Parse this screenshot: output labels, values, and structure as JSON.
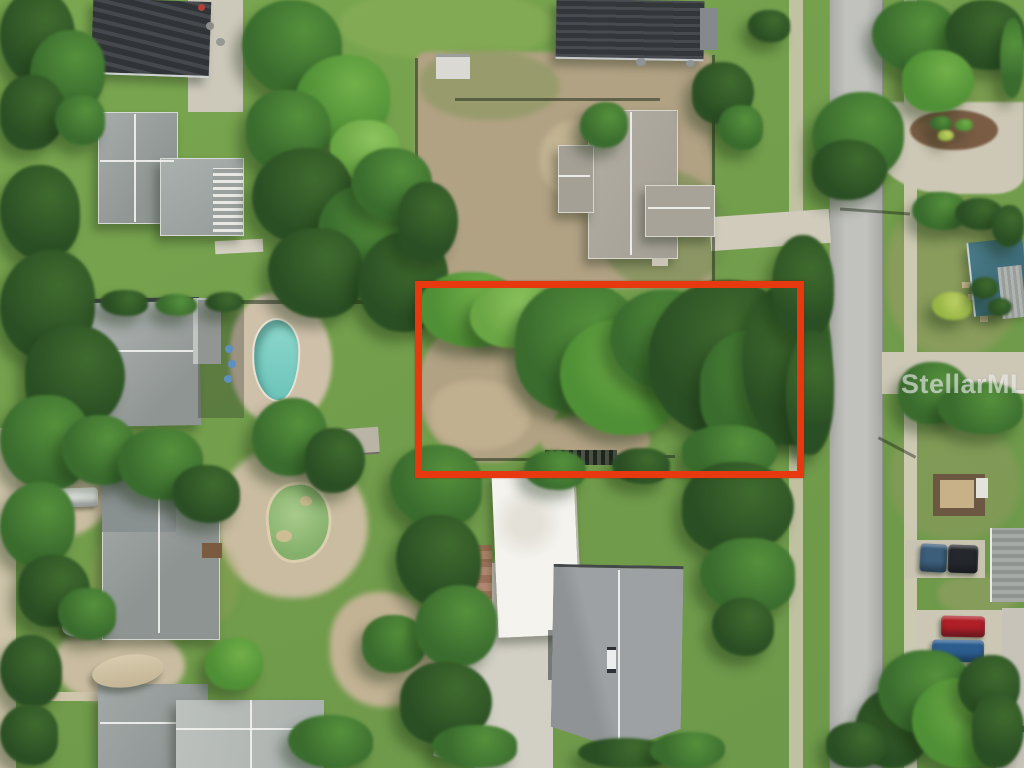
{
  "watermark": {
    "text": "StellarMLS",
    "color": "rgba(255,255,255,0.55)",
    "x": 901,
    "y": 369,
    "font_size": 27
  },
  "boundary": {
    "x": 415,
    "y": 281,
    "width": 375,
    "height": 183,
    "stroke_width": 7,
    "color": "#e7380f"
  },
  "palette": {
    "grass": "#74a04e",
    "dirt": "#b2a284",
    "sand": "#c9bca0",
    "road": "#b6b7b3",
    "concrete": "#cdc8b6",
    "pool_water": "#7fd0c5",
    "pond_water": "#94bb78",
    "dark_roof": "#3a3e42",
    "gray_roof": "#9ba19f",
    "tan_roof": "#aca79d",
    "white_roof": "#f4f3ee",
    "teal_roof": "#42707e",
    "trees": {
      "dark": {
        "fill": "#2b4f24",
        "hi": "#3f6b2e"
      },
      "mid": {
        "fill": "#3a6c2e",
        "hi": "#55913c"
      },
      "bright": {
        "fill": "#4f8f35",
        "hi": "#72b04a"
      },
      "light": {
        "fill": "#6aa644",
        "hi": "#8cc45e"
      },
      "yellow": {
        "fill": "#97b545",
        "hi": "#c2d468"
      }
    }
  },
  "scene": {
    "trees": [
      {
        "x": 0,
        "y": -10,
        "w": 75,
        "h": 95,
        "t": "dark"
      },
      {
        "x": 30,
        "y": 30,
        "w": 75,
        "h": 85,
        "t": "mid"
      },
      {
        "x": 0,
        "y": 75,
        "w": 65,
        "h": 75,
        "t": "dark"
      },
      {
        "x": 55,
        "y": 95,
        "w": 50,
        "h": 50,
        "t": "mid"
      },
      {
        "x": 242,
        "y": 0,
        "w": 100,
        "h": 95,
        "t": "mid"
      },
      {
        "x": 295,
        "y": 55,
        "w": 95,
        "h": 90,
        "t": "bright"
      },
      {
        "x": 246,
        "y": 90,
        "w": 85,
        "h": 80,
        "t": "mid"
      },
      {
        "x": 330,
        "y": 120,
        "w": 70,
        "h": 60,
        "t": "light"
      },
      {
        "x": 0,
        "y": 165,
        "w": 80,
        "h": 95,
        "t": "dark"
      },
      {
        "x": 0,
        "y": 250,
        "w": 95,
        "h": 110,
        "t": "dark"
      },
      {
        "x": 25,
        "y": 325,
        "w": 100,
        "h": 105,
        "t": "dark"
      },
      {
        "x": 0,
        "y": 395,
        "w": 90,
        "h": 95,
        "t": "mid"
      },
      {
        "x": 62,
        "y": 415,
        "w": 75,
        "h": 70,
        "t": "mid"
      },
      {
        "x": 252,
        "y": 148,
        "w": 100,
        "h": 95,
        "t": "dark"
      },
      {
        "x": 318,
        "y": 185,
        "w": 105,
        "h": 100,
        "t": "mid"
      },
      {
        "x": 268,
        "y": 228,
        "w": 95,
        "h": 90,
        "t": "dark"
      },
      {
        "x": 352,
        "y": 148,
        "w": 80,
        "h": 72,
        "t": "mid"
      },
      {
        "x": 358,
        "y": 232,
        "w": 90,
        "h": 100,
        "t": "dark"
      },
      {
        "x": 398,
        "y": 182,
        "w": 60,
        "h": 80,
        "t": "dark"
      },
      {
        "x": 100,
        "y": 290,
        "w": 48,
        "h": 26,
        "t": "dark"
      },
      {
        "x": 155,
        "y": 294,
        "w": 42,
        "h": 22,
        "t": "mid"
      },
      {
        "x": 205,
        "y": 292,
        "w": 38,
        "h": 20,
        "t": "dark"
      },
      {
        "x": 428,
        "y": 288,
        "w": 34,
        "h": 22,
        "t": "dark"
      },
      {
        "x": 468,
        "y": 292,
        "w": 30,
        "h": 18,
        "t": "dark"
      },
      {
        "x": 504,
        "y": 290,
        "w": 26,
        "h": 16,
        "t": "dark"
      },
      {
        "x": 580,
        "y": 102,
        "w": 48,
        "h": 46,
        "t": "mid"
      },
      {
        "x": 692,
        "y": 62,
        "w": 62,
        "h": 62,
        "t": "dark"
      },
      {
        "x": 718,
        "y": 105,
        "w": 45,
        "h": 45,
        "t": "mid"
      },
      {
        "x": 418,
        "y": 272,
        "w": 105,
        "h": 75,
        "t": "bright"
      },
      {
        "x": 470,
        "y": 283,
        "w": 85,
        "h": 65,
        "t": "light"
      },
      {
        "x": 515,
        "y": 282,
        "w": 130,
        "h": 130,
        "t": "mid"
      },
      {
        "x": 560,
        "y": 320,
        "w": 120,
        "h": 115,
        "t": "bright"
      },
      {
        "x": 610,
        "y": 290,
        "w": 110,
        "h": 100,
        "t": "mid"
      },
      {
        "x": 648,
        "y": 280,
        "w": 145,
        "h": 155,
        "t": "dark"
      },
      {
        "x": 700,
        "y": 330,
        "w": 115,
        "h": 120,
        "t": "mid"
      },
      {
        "x": 742,
        "y": 285,
        "w": 90,
        "h": 160,
        "t": "dark"
      },
      {
        "x": 772,
        "y": 235,
        "w": 62,
        "h": 105,
        "t": "dark"
      },
      {
        "x": 786,
        "y": 330,
        "w": 48,
        "h": 125,
        "t": "dark"
      },
      {
        "x": 682,
        "y": 425,
        "w": 95,
        "h": 55,
        "t": "mid"
      },
      {
        "x": 612,
        "y": 448,
        "w": 58,
        "h": 36,
        "t": "dark"
      },
      {
        "x": 524,
        "y": 450,
        "w": 62,
        "h": 40,
        "t": "mid"
      },
      {
        "x": 812,
        "y": 92,
        "w": 92,
        "h": 88,
        "t": "mid"
      },
      {
        "x": 812,
        "y": 140,
        "w": 75,
        "h": 60,
        "t": "dark"
      },
      {
        "x": 872,
        "y": 0,
        "w": 85,
        "h": 72,
        "t": "mid"
      },
      {
        "x": 945,
        "y": 0,
        "w": 80,
        "h": 70,
        "t": "dark"
      },
      {
        "x": 1000,
        "y": 18,
        "w": 24,
        "h": 80,
        "t": "mid"
      },
      {
        "x": 902,
        "y": 50,
        "w": 72,
        "h": 62,
        "t": "bright"
      },
      {
        "x": 912,
        "y": 192,
        "w": 55,
        "h": 38,
        "t": "mid"
      },
      {
        "x": 955,
        "y": 198,
        "w": 48,
        "h": 32,
        "t": "dark"
      },
      {
        "x": 992,
        "y": 205,
        "w": 32,
        "h": 42,
        "t": "dark"
      },
      {
        "x": 898,
        "y": 362,
        "w": 72,
        "h": 62,
        "t": "mid"
      },
      {
        "x": 938,
        "y": 382,
        "w": 85,
        "h": 52,
        "t": "mid"
      },
      {
        "x": 932,
        "y": 292,
        "w": 40,
        "h": 28,
        "t": "yellow"
      },
      {
        "x": 970,
        "y": 277,
        "w": 28,
        "h": 22,
        "t": "dark"
      },
      {
        "x": 988,
        "y": 298,
        "w": 24,
        "h": 18,
        "t": "dark"
      },
      {
        "x": 118,
        "y": 428,
        "w": 85,
        "h": 72,
        "t": "mid"
      },
      {
        "x": 172,
        "y": 465,
        "w": 68,
        "h": 58,
        "t": "dark"
      },
      {
        "x": 0,
        "y": 482,
        "w": 75,
        "h": 85,
        "t": "mid"
      },
      {
        "x": 18,
        "y": 555,
        "w": 72,
        "h": 72,
        "t": "dark"
      },
      {
        "x": 58,
        "y": 588,
        "w": 58,
        "h": 52,
        "t": "mid"
      },
      {
        "x": 0,
        "y": 635,
        "w": 62,
        "h": 72,
        "t": "dark"
      },
      {
        "x": 205,
        "y": 638,
        "w": 58,
        "h": 52,
        "t": "bright"
      },
      {
        "x": 362,
        "y": 615,
        "w": 65,
        "h": 58,
        "t": "mid"
      },
      {
        "x": 0,
        "y": 705,
        "w": 58,
        "h": 60,
        "t": "dark"
      },
      {
        "x": 288,
        "y": 715,
        "w": 85,
        "h": 53,
        "t": "mid"
      },
      {
        "x": 252,
        "y": 398,
        "w": 75,
        "h": 78,
        "t": "mid"
      },
      {
        "x": 305,
        "y": 428,
        "w": 60,
        "h": 65,
        "t": "dark"
      },
      {
        "x": 390,
        "y": 445,
        "w": 92,
        "h": 82,
        "t": "mid"
      },
      {
        "x": 396,
        "y": 515,
        "w": 85,
        "h": 92,
        "t": "dark"
      },
      {
        "x": 415,
        "y": 585,
        "w": 82,
        "h": 82,
        "t": "mid"
      },
      {
        "x": 400,
        "y": 662,
        "w": 92,
        "h": 82,
        "t": "dark"
      },
      {
        "x": 432,
        "y": 725,
        "w": 85,
        "h": 43,
        "t": "mid"
      },
      {
        "x": 578,
        "y": 738,
        "w": 92,
        "h": 30,
        "t": "dark"
      },
      {
        "x": 650,
        "y": 732,
        "w": 75,
        "h": 36,
        "t": "mid"
      },
      {
        "x": 682,
        "y": 462,
        "w": 112,
        "h": 92,
        "t": "dark"
      },
      {
        "x": 700,
        "y": 538,
        "w": 95,
        "h": 75,
        "t": "mid"
      },
      {
        "x": 712,
        "y": 598,
        "w": 62,
        "h": 58,
        "t": "dark"
      },
      {
        "x": 855,
        "y": 688,
        "w": 75,
        "h": 80,
        "t": "dark"
      },
      {
        "x": 826,
        "y": 722,
        "w": 62,
        "h": 46,
        "t": "dark"
      },
      {
        "x": 878,
        "y": 650,
        "w": 95,
        "h": 85,
        "t": "mid"
      },
      {
        "x": 912,
        "y": 678,
        "w": 95,
        "h": 90,
        "t": "bright"
      },
      {
        "x": 958,
        "y": 655,
        "w": 62,
        "h": 62,
        "t": "dark"
      },
      {
        "x": 972,
        "y": 692,
        "w": 52,
        "h": 76,
        "t": "dark"
      },
      {
        "x": 748,
        "y": 10,
        "w": 42,
        "h": 32,
        "t": "dark"
      },
      {
        "x": 930,
        "y": 116,
        "w": 22,
        "h": 15,
        "t": "mid"
      },
      {
        "x": 955,
        "y": 119,
        "w": 18,
        "h": 12,
        "t": "bright"
      },
      {
        "x": 938,
        "y": 130,
        "w": 16,
        "h": 11,
        "t": "yellow"
      }
    ],
    "vehicles": [
      {
        "name": "pickup-truck",
        "x": 52,
        "y": 287,
        "w": 42,
        "h": 16,
        "color": "#9fa6ab",
        "r": 2
      },
      {
        "name": "white-car",
        "x": 47,
        "y": 314,
        "w": 38,
        "h": 15,
        "color": "#e9eae6",
        "r": 2
      },
      {
        "name": "dark-car",
        "x": 56,
        "y": 337,
        "w": 24,
        "h": 12,
        "color": "#565b60",
        "r": 0
      },
      {
        "name": "carport-car",
        "x": 78,
        "y": 54,
        "w": 18,
        "h": 14,
        "color": "#70767c",
        "r": 0
      },
      {
        "name": "white-car",
        "x": 52,
        "y": 488,
        "w": 46,
        "h": 19,
        "color": "#eceeea",
        "r": -2
      },
      {
        "name": "blue-suv",
        "x": 920,
        "y": 544,
        "w": 27,
        "h": 28,
        "color": "#3c5e7b",
        "r": 3
      },
      {
        "name": "black-van",
        "x": 948,
        "y": 545,
        "w": 30,
        "h": 28,
        "color": "#24272c",
        "r": 2
      },
      {
        "name": "red-car",
        "x": 941,
        "y": 616,
        "w": 44,
        "h": 21,
        "color": "#b01f28",
        "r": 1
      },
      {
        "name": "blue-car",
        "x": 932,
        "y": 640,
        "w": 52,
        "h": 22,
        "color": "#2c5d8f",
        "r": 1
      },
      {
        "name": "kayak",
        "x": 156,
        "y": 450,
        "w": 24,
        "h": 12,
        "color": "#a2cf3a",
        "r": -28
      }
    ]
  }
}
